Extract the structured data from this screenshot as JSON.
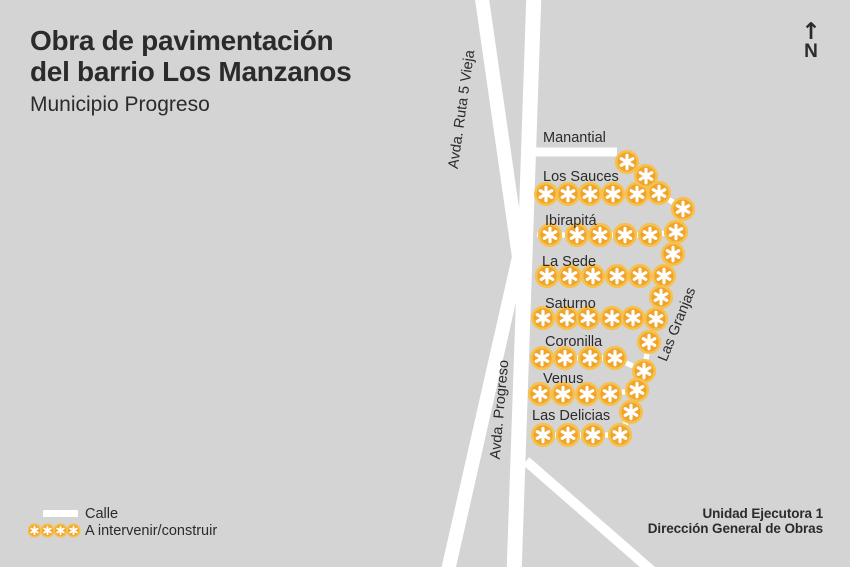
{
  "header": {
    "title_line1": "Obra de pavimentación",
    "title_line2": "del barrio Los Manzanos",
    "subtitle": "Municipio Progreso"
  },
  "compass": {
    "arrow": "↑",
    "label": "N"
  },
  "legend": {
    "items": [
      {
        "symbol": "street-bar",
        "label": "Calle"
      },
      {
        "symbol": "intervention-markers",
        "label": "A intervenir/construir"
      }
    ],
    "marker_count": 4
  },
  "credits": {
    "line1": "Unidad Ejecutora 1",
    "line2": "Dirección General de Obras"
  },
  "colors": {
    "background": "#d4d4d4",
    "street": "#ffffff",
    "text": "#2b2b2b",
    "marker_fill": "#f0a42c",
    "marker_ring": "#f6c14c",
    "marker_glyph": "#ffffff"
  },
  "map": {
    "avenues": [
      {
        "name": "Avda. Ruta 5 Vieja",
        "label_x": 466,
        "label_y": 110,
        "label_rotation": -82,
        "width": 14,
        "path": [
          [
            481,
            -8
          ],
          [
            519,
            257
          ],
          [
            447,
            575
          ]
        ]
      },
      {
        "name": "Avda. Progreso",
        "label_x": 504,
        "label_y": 410,
        "label_rotation": -85,
        "width": 15,
        "path": [
          [
            534,
            -8
          ],
          [
            514,
            575
          ]
        ]
      }
    ],
    "streets_existing": [
      {
        "name": "Manantial",
        "label_x": 543,
        "label_y": 142,
        "width": 9,
        "path": [
          [
            536,
            152
          ],
          [
            617,
            152
          ]
        ]
      }
    ],
    "unnamed_streets": [
      {
        "width": 10,
        "path": [
          [
            526,
            461
          ],
          [
            660,
            578
          ]
        ]
      }
    ],
    "intervention_rows": [
      {
        "name": "Los Sauces",
        "label_x": 543,
        "label_y": 181,
        "circles": [
          [
            546,
            194
          ],
          [
            568,
            194
          ],
          [
            590,
            194
          ],
          [
            613,
            194
          ],
          [
            637,
            194
          ],
          [
            659,
            193
          ]
        ]
      },
      {
        "name": "Ibirapitá",
        "label_x": 545,
        "label_y": 225,
        "circles": [
          [
            550,
            235
          ],
          [
            577,
            235
          ],
          [
            600,
            235
          ],
          [
            625,
            235
          ],
          [
            650,
            235
          ],
          [
            676,
            232
          ]
        ]
      },
      {
        "name": "La Sede",
        "label_x": 542,
        "label_y": 266,
        "circles": [
          [
            547,
            276
          ],
          [
            570,
            276
          ],
          [
            593,
            276
          ],
          [
            617,
            276
          ],
          [
            640,
            276
          ],
          [
            664,
            276
          ]
        ]
      },
      {
        "name": "Saturno",
        "label_x": 545,
        "label_y": 308,
        "circles": [
          [
            543,
            318
          ],
          [
            567,
            318
          ],
          [
            588,
            318
          ],
          [
            612,
            318
          ],
          [
            633,
            318
          ],
          [
            656,
            319
          ]
        ]
      },
      {
        "name": "Coronilla",
        "label_x": 545,
        "label_y": 346,
        "circles": [
          [
            542,
            358
          ],
          [
            565,
            358
          ],
          [
            590,
            358
          ],
          [
            615,
            358
          ],
          [
            644,
            371
          ]
        ]
      },
      {
        "name": "Venus",
        "label_x": 543,
        "label_y": 383,
        "circles": [
          [
            540,
            394
          ],
          [
            563,
            394
          ],
          [
            587,
            394
          ],
          [
            610,
            394
          ],
          [
            637,
            390
          ]
        ]
      },
      {
        "name": "Las Delicias",
        "label_x": 532,
        "label_y": 420,
        "circles": [
          [
            543,
            435
          ],
          [
            568,
            435
          ],
          [
            593,
            435
          ],
          [
            620,
            435
          ]
        ]
      }
    ],
    "intervention_diagonal": {
      "name": "Las Granjas",
      "label_x": 681,
      "label_y": 326,
      "label_rotation": -68,
      "circles": [
        [
          627,
          162
        ],
        [
          646,
          176
        ],
        [
          659,
          193
        ],
        [
          683,
          209
        ],
        [
          676,
          232
        ],
        [
          673,
          254
        ],
        [
          664,
          276
        ],
        [
          661,
          297
        ],
        [
          656,
          319
        ],
        [
          649,
          342
        ],
        [
          644,
          371
        ],
        [
          637,
          390
        ],
        [
          631,
          412
        ],
        [
          620,
          435
        ]
      ]
    },
    "marker": {
      "radius": 10.8,
      "legend_radius": 6.3
    }
  }
}
